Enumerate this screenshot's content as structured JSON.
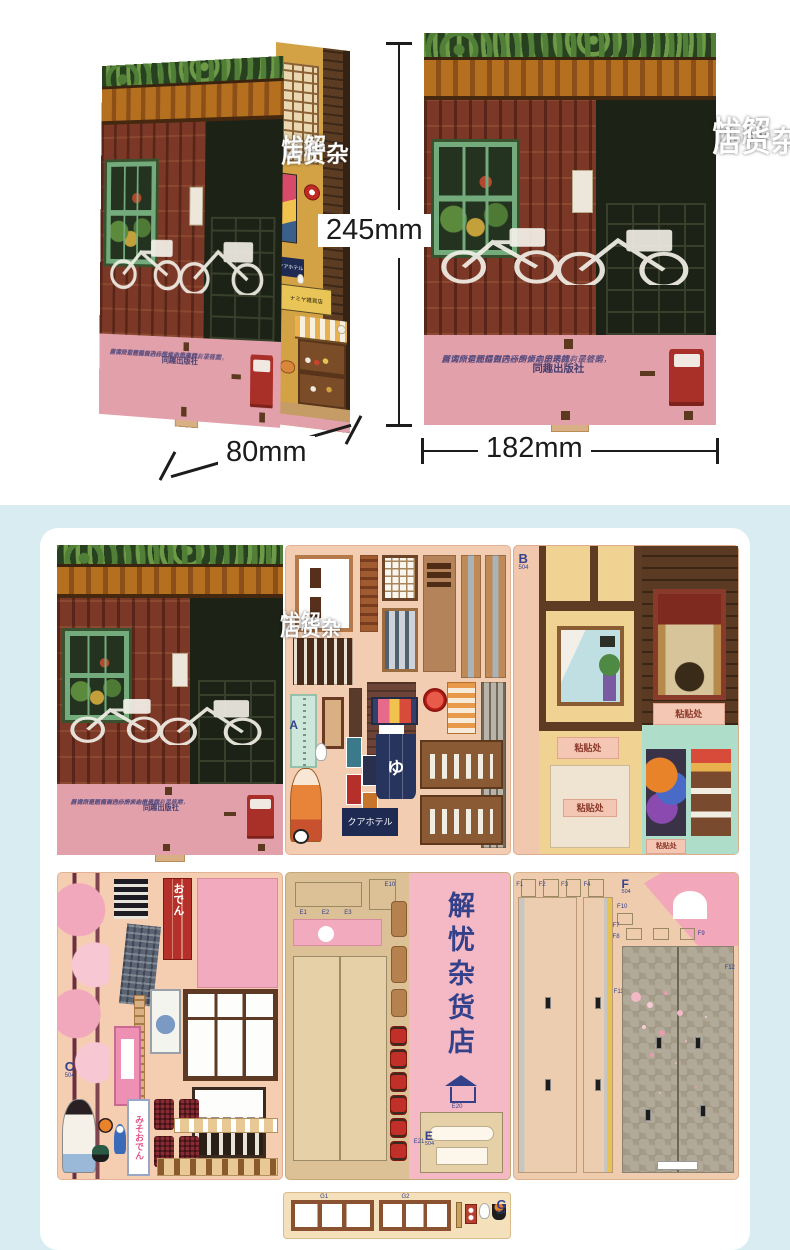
{
  "top": {
    "height_label": "245mm",
    "depth_label": "80mm",
    "width_label": "182mm"
  },
  "cover": {
    "title_col_right": "解忧",
    "title_col_left": "杂货店",
    "quote_line1": "其实所有面临做选择的人心里早就有了答案，",
    "quote_line2": "咨询只是想得到内心所倾向的选择。最终的",
    "quote_line3": "所谓命运还是自己一步步走出来的。",
    "publisher": "同趣出版社"
  },
  "interior": {
    "shop_sign": "ナミヤ雑貨店",
    "hotel_sign": "クアホテル"
  },
  "panels": {
    "a": {
      "label": "A",
      "bath_noren": "ゆ",
      "hotel_sign": "クアホテル"
    },
    "b": {
      "label": "B",
      "code": "504",
      "paste": "粘贴处"
    },
    "c": {
      "label": "C",
      "code": "504",
      "noren_oden": "おでん",
      "banner_misooden": "みそおでん"
    },
    "e": {
      "label": "E",
      "code": "504",
      "spine_title": "解忧杂货店",
      "parts": [
        "E1",
        "E2",
        "E3",
        "E10",
        "E20",
        "E21"
      ]
    },
    "f": {
      "label": "F",
      "code": "504",
      "parts": [
        "F1",
        "F2",
        "F3",
        "F4",
        "F7",
        "F8",
        "F9",
        "F10",
        "F11",
        "F12"
      ]
    },
    "g": {
      "label": "G",
      "code": "504",
      "parts": [
        "G1",
        "G2"
      ]
    }
  },
  "colors": {
    "kit_section_bg": "#d8ecf2",
    "cover_pink_strip": "#e2a0ab",
    "panel_label_navy": "#34418c",
    "mailbox_red": "#a93028"
  }
}
